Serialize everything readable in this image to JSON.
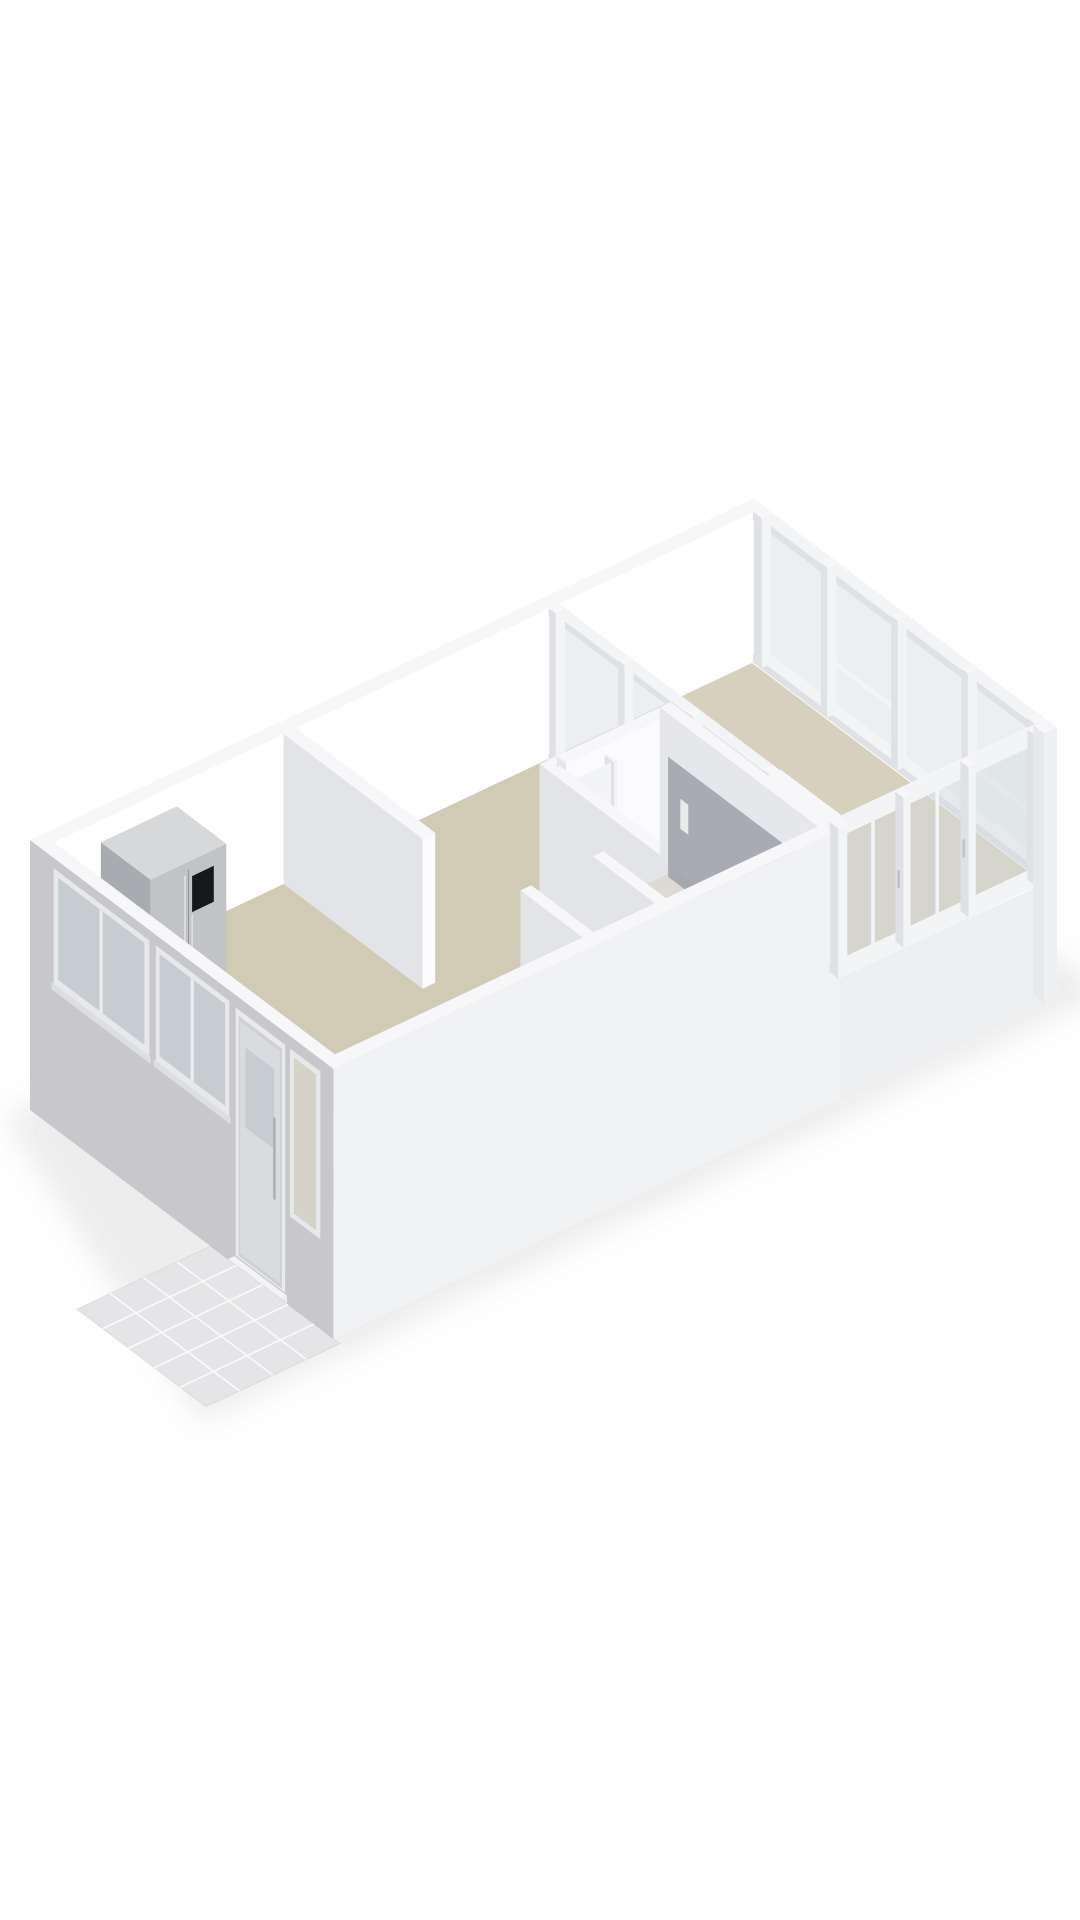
{
  "meta": {
    "view": "3d-floorplan-isometric-render",
    "background": "#ffffff"
  },
  "palette": {
    "wall_top": "#f7f7f9",
    "wall_inner_bright": "#ffffff",
    "wall_inner_soft": "#fbfbfd",
    "wall_shade": "#e2e3e6",
    "facade_sw": "#c8c8cc",
    "facade_se": "#f1f2f4",
    "facade_plinth": "#edeff1",
    "floor_main": "#d1cab4",
    "floor_balcony": "#d6d0bc",
    "floor_bath": "#e7e5de",
    "floor_niche": "#f1f1f2",
    "glass": "rgba(213,220,223,0.45)",
    "glass_dark": "#c6cccf",
    "frame": "#f3f4f6",
    "frame_shade": "#dfe1e4",
    "steel": "#b9bcbf",
    "steel_dark": "#a8abaf",
    "steel_mid": "#c1c3c6",
    "black_panel": "#17181a",
    "tile": "#e5e5e8",
    "tile_joint": "#fafafb",
    "shadow": "rgba(125,125,138,0.14)"
  },
  "projection": {
    "origin": [
      30,
      990
    ],
    "uL": [
      0.9044,
      -0.4268
    ],
    "uS": [
      0.7985,
      0.602
    ],
    "wall_height": 150,
    "plinth_depth": 120,
    "wall_thickness": 14
  },
  "building": {
    "length": 800,
    "width": 380
  },
  "scene": [
    {
      "t": "poly",
      "name": "building-ground-shadow",
      "pts": [
        [
          -25,
          -5,
          -120
        ],
        [
          812,
          -18,
          -120
        ],
        [
          840,
          400,
          -120
        ],
        [
          -165,
          402,
          -120
        ]
      ],
      "fill": "$shadow",
      "blur": 16
    },
    {
      "t": "box",
      "name": "exterior-wall-nw",
      "x0": 0,
      "y0": 0,
      "x1": 800,
      "y1": 14,
      "h0": 0,
      "h1": 150,
      "top": "$wall_top",
      "sw": "$wall_shade",
      "se": "$wall_inner_bright"
    },
    {
      "t": "box",
      "name": "exterior-wall-ne-top-band",
      "x0": 786,
      "y0": 0,
      "x1": 800,
      "y1": 380,
      "h0": 150,
      "h1": 150,
      "top": "$wall_top"
    },
    {
      "t": "glazing",
      "name": "balcony-windows-ne",
      "axis": "x",
      "frame": [
        786,
        800
      ],
      "glassAt": 793,
      "span": [
        14,
        366
      ],
      "posts": [
        [
          14,
          24
        ],
        [
          98,
          106
        ],
        [
          186,
          194
        ],
        [
          274,
          282
        ],
        [
          356,
          366
        ]
      ],
      "glass": [
        8,
        142
      ],
      "rails": [
        [
          0,
          8
        ],
        [
          142,
          150
        ]
      ],
      "midRails": {
        "panes": [
          1,
          3
        ],
        "h": [
          52,
          58
        ]
      }
    },
    {
      "t": "floor",
      "name": "balcony-floor",
      "x0": 574,
      "y0": 14,
      "x1": 786,
      "y1": 366,
      "h": 0,
      "fill": "$floor_balcony"
    },
    {
      "t": "glazing",
      "name": "living-balcony-partition-glazing",
      "axis": "x",
      "frame": [
        560,
        574
      ],
      "glassAt": 567,
      "span": [
        14,
        290
      ],
      "posts": [
        [
          14,
          22
        ],
        [
          100,
          108
        ],
        [
          186,
          194
        ],
        [
          282,
          290
        ]
      ],
      "glass": [
        6,
        143
      ],
      "rails": [
        [
          0,
          6
        ],
        [
          143,
          150
        ]
      ],
      "midRails": {
        "panes": [],
        "h": [
          0,
          0
        ]
      }
    },
    {
      "t": "box",
      "name": "partition-wall-block",
      "x0": 560,
      "y0": 290,
      "x1": 574,
      "y1": 366,
      "h0": 0,
      "h1": 150,
      "top": "$wall_top",
      "sw": "#e6e7ea",
      "se": "$wall_inner_soft"
    },
    {
      "t": "floor",
      "name": "main-floor-kitchen-hall-living",
      "x0": 14,
      "y0": 14,
      "x1": 560,
      "y1": 366,
      "h": 0,
      "fill": "$floor_main"
    },
    {
      "t": "box",
      "name": "kitchen-wall-stub",
      "x0": 268,
      "y0": 14,
      "x1": 282,
      "y1": 188,
      "h0": 0,
      "h1": 150,
      "top": "$wall_top",
      "sw": "#e3e4e7",
      "se": "$wall_inner_soft"
    },
    {
      "t": "box",
      "name": "kitchen-counter",
      "x0": 14,
      "y0": 14,
      "x1": 46,
      "y1": 332,
      "h0": 0,
      "h1": 55,
      "top": "#fcfcfd",
      "sw": "#e9eaec",
      "se": "#f0f1f3"
    },
    {
      "t": "floor",
      "name": "kitchen-sink-rim",
      "x0": 18,
      "y0": 152,
      "x1": 42,
      "y1": 230,
      "h": 55.5,
      "fill": "#c7cacc"
    },
    {
      "t": "floor",
      "name": "kitchen-sink-basin",
      "x0": 21,
      "y0": 157,
      "x1": 39,
      "y1": 226,
      "h": 55.8,
      "fill": "#b2b6b9"
    },
    {
      "t": "box",
      "name": "kitchen-faucet",
      "x0": 27,
      "y0": 146,
      "x1": 31,
      "y1": 150,
      "h0": 55,
      "h1": 73,
      "top": "#d0d2d4",
      "sw": "$steel",
      "se": "$steel"
    },
    {
      "t": "floor",
      "name": "kitchen-hob",
      "x0": 20,
      "y0": 288,
      "x1": 42,
      "y1": 320,
      "h": 55.4,
      "fill": "#d8dadb"
    },
    {
      "t": "floor",
      "name": "kitchen-hob-burner-1",
      "x0": 24,
      "y0": 294,
      "x1": 30,
      "y1": 300,
      "h": 55.7,
      "fill": "#9fa2a5"
    },
    {
      "t": "floor",
      "name": "kitchen-hob-burner-2",
      "x0": 32,
      "y0": 306,
      "x1": 38,
      "y1": 312,
      "h": 55.7,
      "fill": "#9fa2a5"
    },
    {
      "t": "box",
      "name": "kitchen-cabinet",
      "x0": 46,
      "y0": 14,
      "x1": 66,
      "y1": 76,
      "h0": 0,
      "h1": 55,
      "top": "#fcfcfd",
      "sw": "#eaebed",
      "se": "#f1f2f4"
    },
    {
      "t": "box",
      "name": "refrigerator",
      "x0": 66,
      "y0": 14,
      "x1": 150,
      "y1": 76,
      "h0": 0,
      "h1": 128,
      "top": "#d7d8da",
      "sw": "$steel_dark",
      "se": "$steel_mid"
    },
    {
      "t": "panel",
      "name": "fridge-door-seam",
      "plane": "y",
      "at": 76.2,
      "u": [
        107.5,
        108.5
      ],
      "h": [
        8,
        120
      ],
      "fill": "#8c8f93"
    },
    {
      "t": "panel",
      "name": "fridge-display-panel",
      "plane": "y",
      "at": 76.2,
      "u": [
        112,
        136
      ],
      "h": [
        76,
        112
      ],
      "fill": "$black_panel"
    },
    {
      "t": "panel",
      "name": "fridge-handle-left",
      "plane": "y",
      "at": 76.3,
      "u": [
        103,
        105
      ],
      "h": [
        18,
        116
      ],
      "fill": "#dcdee0"
    },
    {
      "t": "panel",
      "name": "fridge-handle-right",
      "plane": "y",
      "at": 76.3,
      "u": [
        111,
        113
      ],
      "h": [
        18,
        74
      ],
      "fill": "#dcdee0"
    },
    {
      "t": "floor",
      "name": "bathroom-floor",
      "x0": 427,
      "y0": 180,
      "x1": 548,
      "y1": 366,
      "h": 0.3,
      "fill": "$floor_bath"
    },
    {
      "t": "box",
      "name": "bathroom-wall-nw-left",
      "x0": 415,
      "y0": 168,
      "x1": 434,
      "y1": 180,
      "h0": 0,
      "h1": 150,
      "top": "$wall_top",
      "sw": "#e3e4e7",
      "se": "$wall_inner_soft"
    },
    {
      "t": "box",
      "name": "bathroom-wall-nw-right",
      "x0": 490,
      "y0": 168,
      "x1": 548,
      "y1": 180,
      "h0": 0,
      "h1": 150,
      "top": "$wall_top",
      "sw": "#e3e4e7",
      "se": "$wall_inner_soft"
    },
    {
      "t": "box",
      "name": "bathroom-door-header",
      "x0": 434,
      "y0": 168,
      "x1": 490,
      "y1": 180,
      "h0": 128,
      "h1": 150,
      "top": "$wall_top",
      "sw": "#e6e7ea",
      "se": "$wall_inner_soft"
    },
    {
      "t": "box",
      "name": "bathroom-door-frame-left",
      "x0": 434,
      "y0": 168,
      "x1": 437,
      "y1": 180,
      "h0": 0,
      "h1": 128,
      "top": "$frame",
      "sw": "$frame_shade",
      "se": "$frame"
    },
    {
      "t": "box",
      "name": "bathroom-door-frame-right",
      "x0": 487,
      "y0": 168,
      "x1": 490,
      "y1": 180,
      "h0": 0,
      "h1": 128,
      "top": "$frame",
      "sw": "$frame_shade",
      "se": "$frame"
    },
    {
      "t": "panel",
      "name": "bathroom-door-leaf",
      "plane": "y",
      "at": 176,
      "u": [
        437,
        487
      ],
      "h": [
        0,
        126
      ],
      "fill": "#f3f4f6"
    },
    {
      "t": "panel",
      "name": "bathroom-door-knob",
      "plane": "y",
      "at": 176.4,
      "u": [
        480,
        483
      ],
      "h": [
        58,
        66
      ],
      "fill": "#b8bbbe"
    },
    {
      "t": "box",
      "name": "bathroom-wall-sw",
      "x0": 415,
      "y0": 180,
      "x1": 427,
      "y1": 366,
      "h0": 0,
      "h1": 150,
      "top": "$wall_top",
      "sw": "#e3e4e7",
      "se": "$wall_inner_soft"
    },
    {
      "t": "box",
      "name": "bathroom-wall-ne",
      "x0": 548,
      "y0": 168,
      "x1": 560,
      "y1": 366,
      "h0": 0,
      "h1": 150,
      "top": "$wall_top",
      "sw": "#e6e7ea",
      "se": "$wall_inner_soft"
    },
    {
      "t": "floor",
      "name": "shower-tray",
      "x0": 500,
      "y0": 190,
      "x1": 546,
      "y1": 358,
      "h": 0.8,
      "fill": "#dcdad2"
    },
    {
      "t": "panel",
      "name": "shower-glass-door",
      "plane": "x",
      "at": 536,
      "u": [
        192,
        356
      ],
      "h": [
        0,
        120
      ],
      "fill": "rgba(150,155,161,0.78)"
    },
    {
      "t": "panel",
      "name": "shower-glass-handle",
      "plane": "x",
      "at": 535.4,
      "u": [
        208,
        218
      ],
      "h": [
        58,
        88
      ],
      "fill": "#e9eaec"
    },
    {
      "t": "box",
      "name": "hall-wall-stub-left",
      "x0": 288,
      "y0": 288,
      "x1": 300,
      "y1": 366,
      "h0": 0,
      "h1": 150,
      "top": "$wall_top",
      "sw": "#e3e4e7",
      "se": "$wall_inner_soft"
    },
    {
      "t": "floor",
      "name": "shoe-closet-floor",
      "x0": 300,
      "y0": 288,
      "x1": 368,
      "y1": 366,
      "h": 0.3,
      "fill": "$floor_niche"
    },
    {
      "t": "box",
      "name": "shoe-1",
      "x0": 308,
      "y0": 316,
      "x1": 316,
      "y1": 330,
      "h0": 0,
      "h1": 9,
      "top": "#8a4a2e",
      "sw": "#713a22",
      "se": "#7c3d25"
    },
    {
      "t": "box",
      "name": "shoe-2",
      "x0": 318,
      "y0": 318,
      "x1": 326,
      "y1": 332,
      "h0": 0,
      "h1": 9,
      "top": "#4a372c",
      "sw": "#3a2c26",
      "se": "#42322a"
    },
    {
      "t": "box",
      "name": "shoe-3",
      "x0": 328,
      "y0": 320,
      "x1": 336,
      "y1": 334,
      "h0": 0,
      "h1": 10,
      "top": "#2c2c2f",
      "sw": "#232326",
      "se": "#262629"
    },
    {
      "t": "box",
      "name": "shoe-4",
      "x0": 340,
      "y0": 322,
      "x1": 348,
      "y1": 336,
      "h0": 0,
      "h1": 9,
      "top": "#96522f",
      "sw": "#7c3d25",
      "se": "#8a4a2e"
    },
    {
      "t": "box",
      "name": "shoe-5",
      "x0": 350,
      "y0": 324,
      "x1": 358,
      "y1": 338,
      "h0": 0,
      "h1": 9,
      "top": "#303033",
      "sw": "#27272a",
      "se": "#2b2b2e"
    },
    {
      "t": "box",
      "name": "hall-wall-stub-right",
      "x0": 368,
      "y0": 288,
      "x1": 380,
      "y1": 366,
      "h0": 0,
      "h1": 150,
      "top": "$wall_top",
      "sw": "#e3e4e7",
      "se": "$wall_inner_soft"
    },
    {
      "t": "box",
      "name": "exterior-wall-se",
      "x0": 0,
      "y0": 366,
      "x1": 560,
      "y1": 380,
      "h0": -120,
      "h1": 150,
      "top": "$wall_top",
      "sw": "#d2d3d6",
      "se": "$facade_se"
    },
    {
      "t": "panel",
      "name": "facade-se-balcony-plinth",
      "plane": "y",
      "at": 380,
      "u": [
        560,
        800
      ],
      "h": [
        -120,
        0
      ],
      "fill": "$facade_plinth"
    },
    {
      "t": "box",
      "name": "exterior-wall-se-balcony-top-band",
      "x0": 560,
      "y0": 366,
      "x1": 800,
      "y1": 380,
      "h0": 150,
      "h1": 150,
      "top": "$wall_top"
    },
    {
      "t": "glazing",
      "name": "balcony-windows-se",
      "axis": "y",
      "frame": [
        366,
        380
      ],
      "glassAt": 374,
      "span": [
        560,
        786
      ],
      "posts": [
        [
          560,
          570
        ],
        [
          632,
          640
        ],
        [
          704,
          712
        ],
        [
          778,
          786
        ]
      ],
      "glass": [
        8,
        142
      ],
      "rails": [
        [
          0,
          8
        ],
        [
          142,
          150
        ]
      ],
      "midRails": {
        "panes": [],
        "h": [
          0,
          0
        ]
      }
    },
    {
      "t": "panel",
      "name": "balcony-window-casement-bar-1",
      "plane": "y",
      "at": 375,
      "u": [
        599,
        603
      ],
      "h": [
        8,
        142
      ],
      "fill": "$frame"
    },
    {
      "t": "panel",
      "name": "balcony-window-casement-bar-2",
      "plane": "y",
      "at": 375,
      "u": [
        670,
        674
      ],
      "h": [
        8,
        142
      ],
      "fill": "$frame"
    },
    {
      "t": "panel",
      "name": "balcony-window-handle-1",
      "plane": "y",
      "at": 376,
      "u": [
        627,
        630
      ],
      "h": [
        60,
        78
      ],
      "fill": "#c0c3c6"
    },
    {
      "t": "panel",
      "name": "balcony-window-handle-2",
      "plane": "y",
      "at": 376,
      "u": [
        699,
        702
      ],
      "h": [
        60,
        78
      ],
      "fill": "#c0c3c6"
    },
    {
      "t": "box",
      "name": "corner-post-east",
      "x0": 786,
      "y0": 366,
      "x1": 800,
      "y1": 380,
      "h0": -120,
      "h1": 150,
      "top": "$wall_top",
      "sw": "#e8e9ec",
      "se": "#eef0f2"
    },
    {
      "t": "box",
      "name": "exterior-wall-sw-facade",
      "x0": 0,
      "y0": 0,
      "x1": 14,
      "y1": 380,
      "h0": -120,
      "h1": 150,
      "top": "$wall_top",
      "sw": "$facade_sw",
      "se": null
    },
    {
      "t": "panel",
      "name": "kitchen-window-1-frame",
      "plane": "x",
      "at": -0.4,
      "u": [
        30,
        150
      ],
      "h": [
        24,
        140
      ],
      "fill": "#e7e8ea"
    },
    {
      "t": "panel",
      "name": "kitchen-window-1-glass",
      "plane": "x",
      "at": -0.6,
      "u": [
        36,
        144
      ],
      "h": [
        32,
        134
      ],
      "fill": "$glass_dark"
    },
    {
      "t": "panel",
      "name": "kitchen-window-1-mullion",
      "plane": "x",
      "at": -0.8,
      "u": [
        88,
        92
      ],
      "h": [
        32,
        134
      ],
      "fill": "#eceded"
    },
    {
      "t": "panel",
      "name": "kitchen-window-1-sill",
      "plane": "x",
      "at": -1.0,
      "u": [
        28,
        152
      ],
      "h": [
        18,
        25
      ],
      "fill": "#dddee1"
    },
    {
      "t": "panel",
      "name": "kitchen-window-2-frame",
      "plane": "x",
      "at": -0.4,
      "u": [
        158,
        250
      ],
      "h": [
        24,
        140
      ],
      "fill": "#e7e8ea"
    },
    {
      "t": "panel",
      "name": "kitchen-window-2-glass",
      "plane": "x",
      "at": -0.6,
      "u": [
        163,
        245
      ],
      "h": [
        32,
        134
      ],
      "fill": "$glass_dark"
    },
    {
      "t": "panel",
      "name": "kitchen-window-2-mullion",
      "plane": "x",
      "at": -0.8,
      "u": [
        202,
        206
      ],
      "h": [
        32,
        134
      ],
      "fill": "#eceded"
    },
    {
      "t": "panel",
      "name": "kitchen-window-2-sill",
      "plane": "x",
      "at": -1.0,
      "u": [
        156,
        252
      ],
      "h": [
        18,
        25
      ],
      "fill": "#dddee1"
    },
    {
      "t": "panel",
      "name": "front-door-frame",
      "plane": "x",
      "at": -0.4,
      "u": [
        258,
        320
      ],
      "h": [
        -110,
        138
      ],
      "fill": "#e9eaec"
    },
    {
      "t": "panel",
      "name": "front-door-recess",
      "plane": "x",
      "at": -0.6,
      "u": [
        262,
        316
      ],
      "h": [
        -108,
        132
      ],
      "fill": "#cfd0d3"
    },
    {
      "t": "panel",
      "name": "front-door-leaf",
      "plane": "x",
      "at": -0.8,
      "u": [
        264,
        314
      ],
      "h": [
        -104,
        128
      ],
      "fill": "#dadbde"
    },
    {
      "t": "panel",
      "name": "front-door-glass",
      "plane": "x",
      "at": -1.0,
      "u": [
        271,
        307
      ],
      "h": [
        26,
        106
      ],
      "fill": "$glass_dark"
    },
    {
      "t": "panel",
      "name": "front-door-handle-bar",
      "plane": "x",
      "at": -1.3,
      "u": [
        306,
        309
      ],
      "h": [
        -24,
        58
      ],
      "fill": "#aaadb1"
    },
    {
      "t": "box",
      "name": "front-door-threshold",
      "x0": -14,
      "y0": 256,
      "x1": 0,
      "y1": 322,
      "h0": -120,
      "h1": -112,
      "top": "#f2f3f5",
      "sw": "#e2e3e6",
      "se": "#eceded"
    },
    {
      "t": "panel",
      "name": "entry-sidelight-frame",
      "plane": "x",
      "at": -0.4,
      "u": [
        326,
        364
      ],
      "h": [
        -30,
        138
      ],
      "fill": "#e7e8ea"
    },
    {
      "t": "panel",
      "name": "entry-sidelight-glass",
      "plane": "x",
      "at": -0.6,
      "u": [
        331,
        359
      ],
      "h": [
        -24,
        132
      ],
      "fill": "#d5d3c9"
    },
    {
      "t": "tiles",
      "name": "porch-tiles",
      "x0": -148,
      "y0": 226,
      "x1": 0,
      "y1": 388,
      "h": -120,
      "cols": 4,
      "rows": 5,
      "fill": "$tile",
      "joint": "$tile_joint"
    }
  ]
}
